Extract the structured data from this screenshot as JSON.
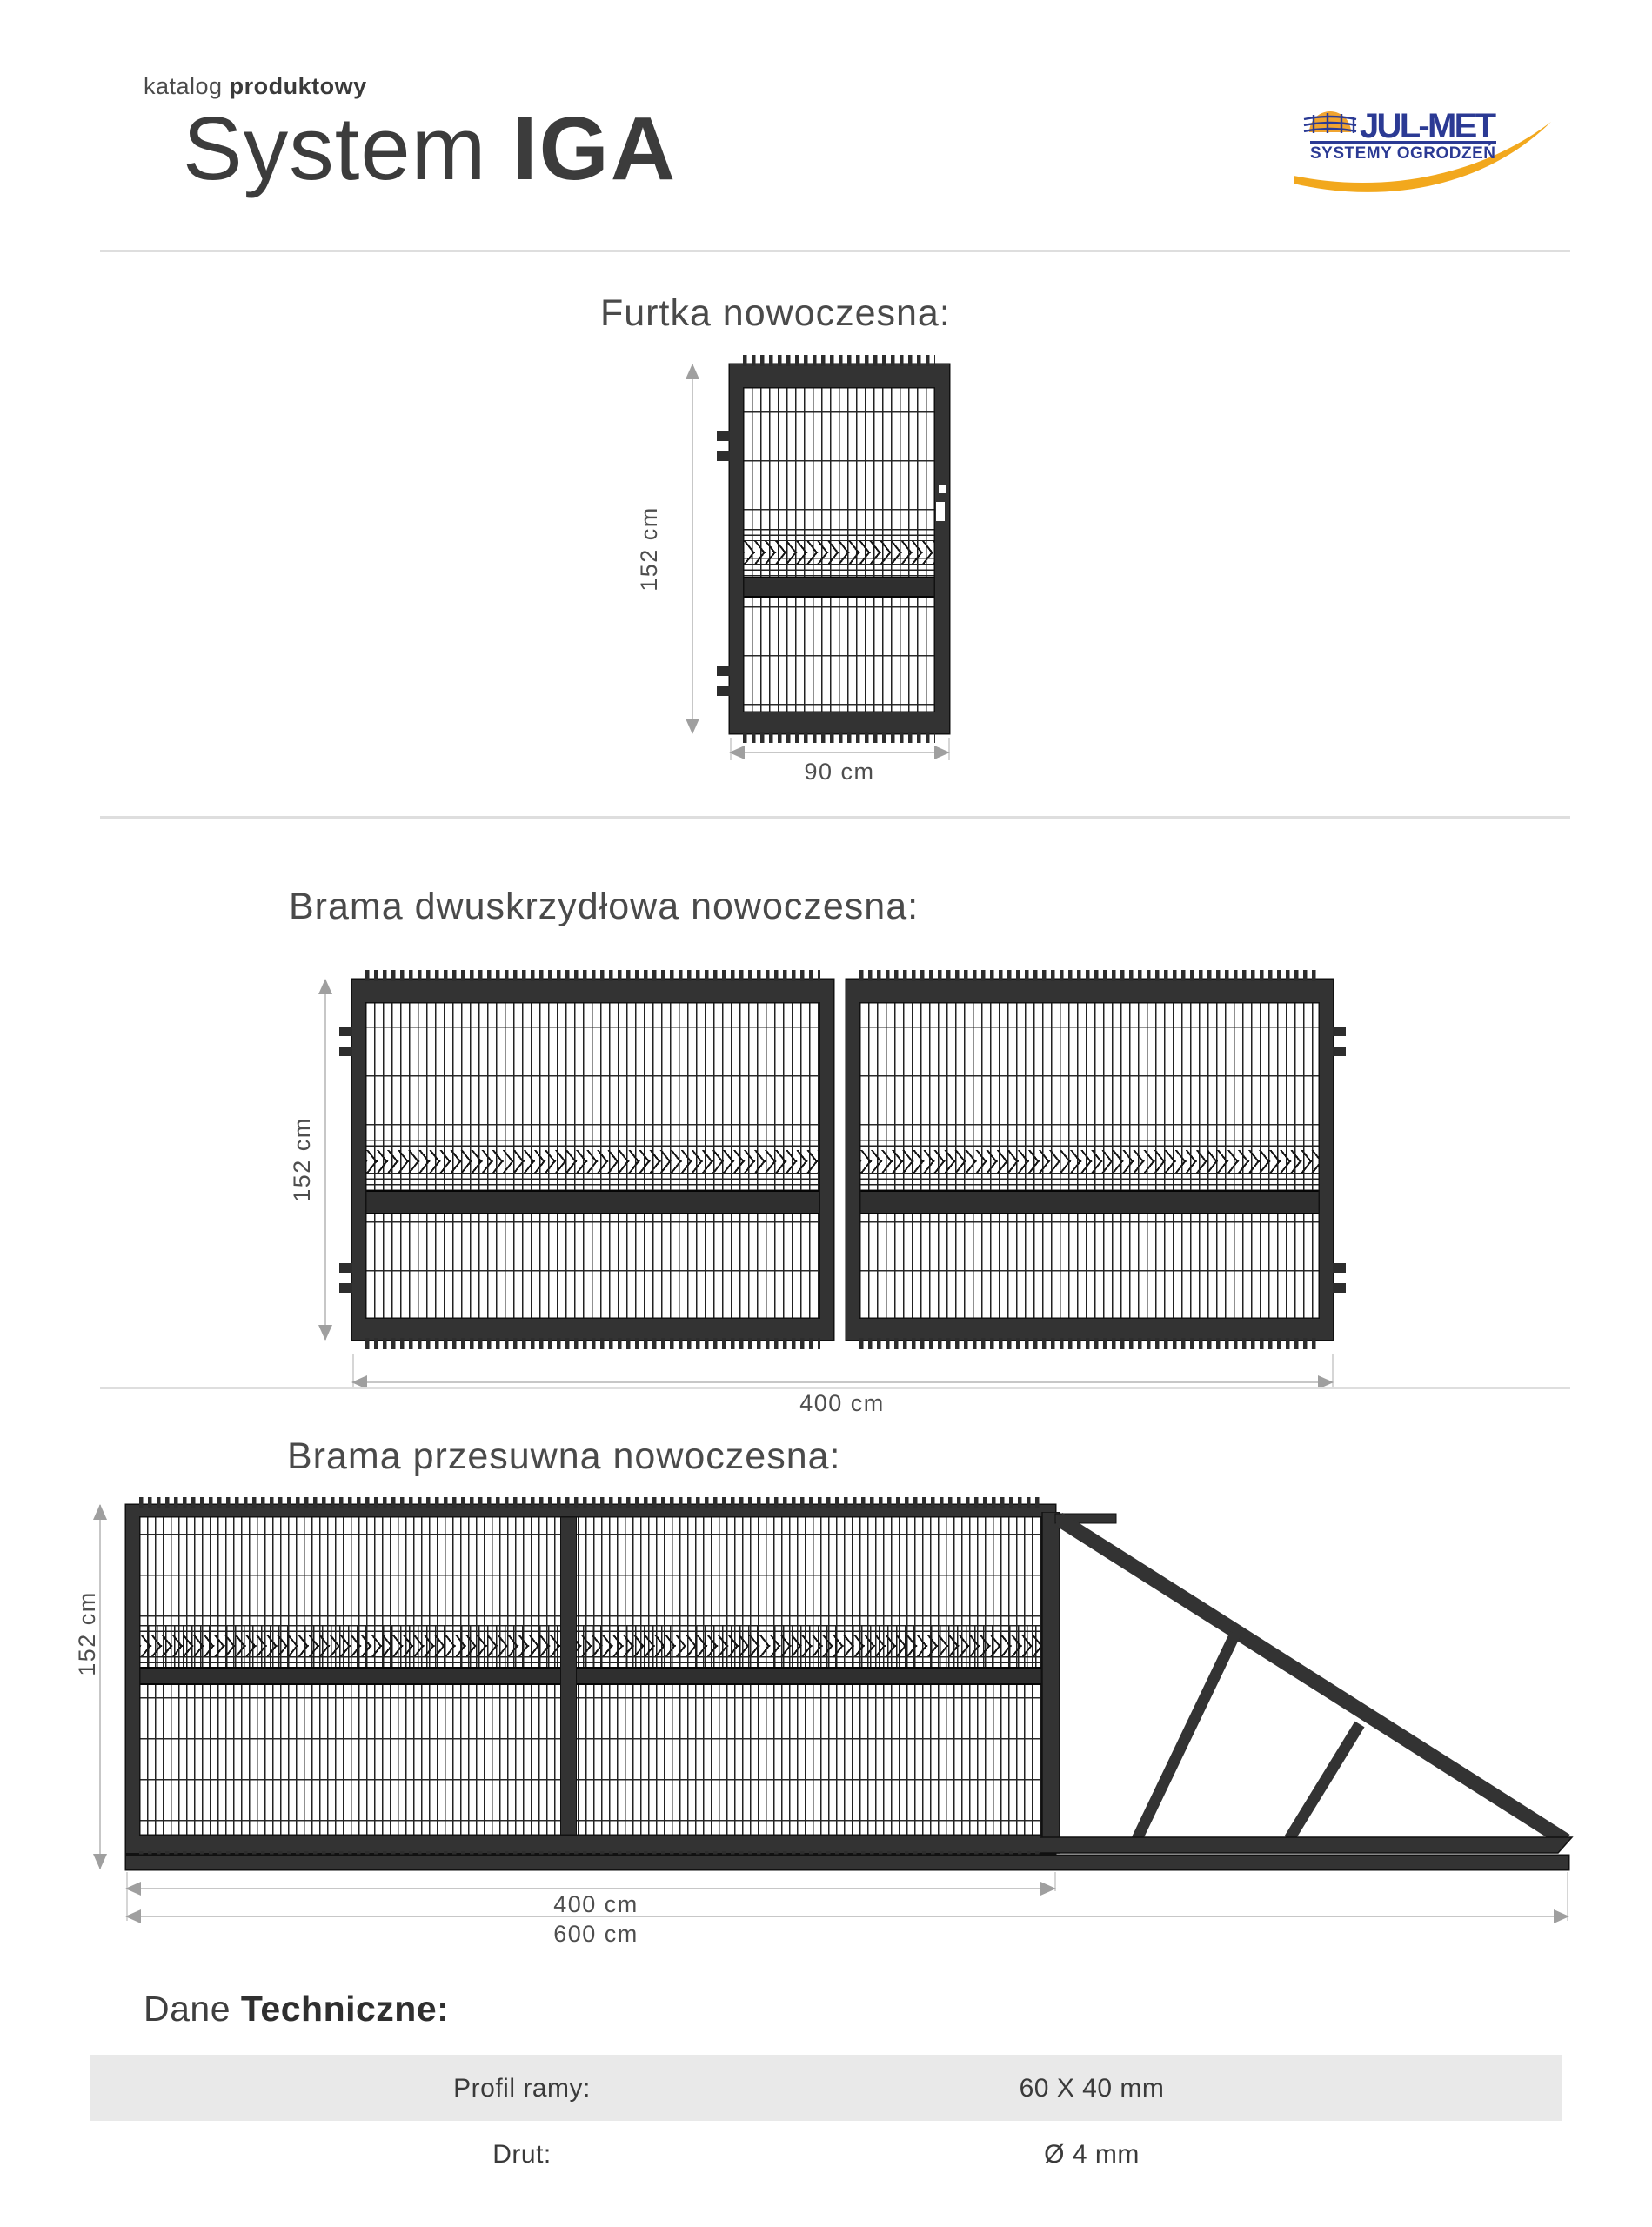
{
  "header": {
    "kicker_light": "katalog",
    "kicker_bold": "produktowy",
    "title_light": "System",
    "title_bold": "IGA"
  },
  "logo": {
    "title": "JUL-MET",
    "subtitle": "SYSTEMY OGRODZEŃ",
    "navy": "#2b3a94",
    "yellow": "#f2a81d",
    "sun": "#f0a430"
  },
  "sections": {
    "furtka": {
      "heading": "Furtka nowoczesna:",
      "dim_height": "152 cm",
      "dim_width": "90 cm"
    },
    "dwuskrzydlowa": {
      "heading": "Brama dwuskrzydłowa nowoczesna:",
      "dim_height": "152 cm",
      "dim_width": "400 cm"
    },
    "przesuwna": {
      "heading": "Brama przesuwna nowoczesna:",
      "dim_height": "152 cm",
      "dim_width_gate": "400 cm",
      "dim_width_total": "600 cm"
    }
  },
  "tech": {
    "heading_light": "Dane",
    "heading_bold": "Techniczne:",
    "rows": [
      {
        "label": "Profil ramy:",
        "value": "60 X 40 mm"
      },
      {
        "label": "Drut:",
        "value": "Ø 4 mm"
      }
    ]
  },
  "drawing_colors": {
    "frame": "#333333",
    "wire": "#222222",
    "dimension": "#9f9f9f"
  }
}
